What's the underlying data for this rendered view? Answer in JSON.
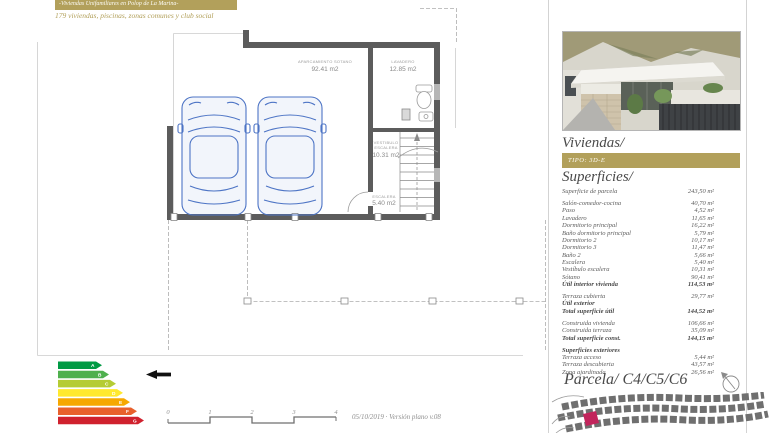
{
  "header": {
    "title": "-Viviendas Unifamiliares en Polop de La Marina-",
    "subtitle": "179 viviendas, piscinas, zonas comunes y club social"
  },
  "plan": {
    "rooms": {
      "garage": {
        "name": "APARCAMIENTO SOTANO",
        "area": "92.41 m2"
      },
      "lavadero": {
        "name": "LAVADERO",
        "area": "12.85 m2"
      },
      "vestibulo": {
        "name_line1": "VESTIBULO",
        "name_line2": "ESCALERA",
        "area": "10.31 m2"
      },
      "escalera": {
        "name": "ESCALERA",
        "area": "5.40 m2"
      }
    },
    "scale_bar": {
      "ticks": [
        "0",
        "1",
        "2",
        "3",
        "4"
      ]
    },
    "footer_note": "05/10/2019 · Versión plano v.08"
  },
  "energy_label": {
    "pointer_grade": "B",
    "grades": [
      {
        "letter": "A",
        "color": "#009a44"
      },
      {
        "letter": "B",
        "color": "#4fb04d"
      },
      {
        "letter": "C",
        "color": "#b5cc34"
      },
      {
        "letter": "D",
        "color": "#ffe92e"
      },
      {
        "letter": "E",
        "color": "#f6a800"
      },
      {
        "letter": "F",
        "color": "#e8602c"
      },
      {
        "letter": "G",
        "color": "#d0212e"
      }
    ]
  },
  "sidebar": {
    "accent_color": "#b2a05b",
    "highlight_parcel_color": "#c2255c",
    "viviendas_heading": "Viviendas/",
    "tipo_badge": "TIPO: 3D-E",
    "superficies_heading": "Superficies/",
    "parcela_surface": {
      "label": "Superficie de parcela",
      "value": "243,50 m²"
    },
    "rows": [
      {
        "label": "Salón-comedor-cocina",
        "value": "40,70 m²"
      },
      {
        "label": "Paso",
        "value": "4,52 m²"
      },
      {
        "label": "Lavadero",
        "value": "11,65 m²"
      },
      {
        "label": "Dormitorio principal",
        "value": "16,22 m²"
      },
      {
        "label": "Baño dormitorio principal",
        "value": "5,79 m²"
      },
      {
        "label": "Dormitorio 2",
        "value": "10,17 m²"
      },
      {
        "label": "Dormitorio 3",
        "value": "11,47 m²"
      },
      {
        "label": "Baño 2",
        "value": "5,66 m²"
      },
      {
        "label": "Escalera",
        "value": "5,40 m²"
      },
      {
        "label": "Vestíbulo escalera",
        "value": "10,31 m²"
      },
      {
        "label": "Sótano",
        "value": "90,41 m²"
      },
      {
        "label": "Útil interior vivienda",
        "value": "114,53 m²"
      },
      {
        "label": "Terraza cubierta",
        "value": "29,77 m²"
      },
      {
        "label": "Útil exterior",
        "value": ""
      },
      {
        "label": "Total superficie útil",
        "value": "144,52 m²"
      },
      {
        "label": "Construida vivienda",
        "value": "106,66 m²"
      },
      {
        "label": "Construida terraza",
        "value": "35,09 m²"
      },
      {
        "label": "Total superficie const.",
        "value": "144,15 m²"
      },
      {
        "label": "Superficies exteriores",
        "value": ""
      },
      {
        "label": "Terraza acceso",
        "value": "5,44 m²"
      },
      {
        "label": "Terraza descubierta",
        "value": "43,57 m²"
      },
      {
        "label": "Zona ajardinada",
        "value": "26,56 m²"
      }
    ],
    "parcela_heading": "Parcela/ C4/C5/C6"
  }
}
